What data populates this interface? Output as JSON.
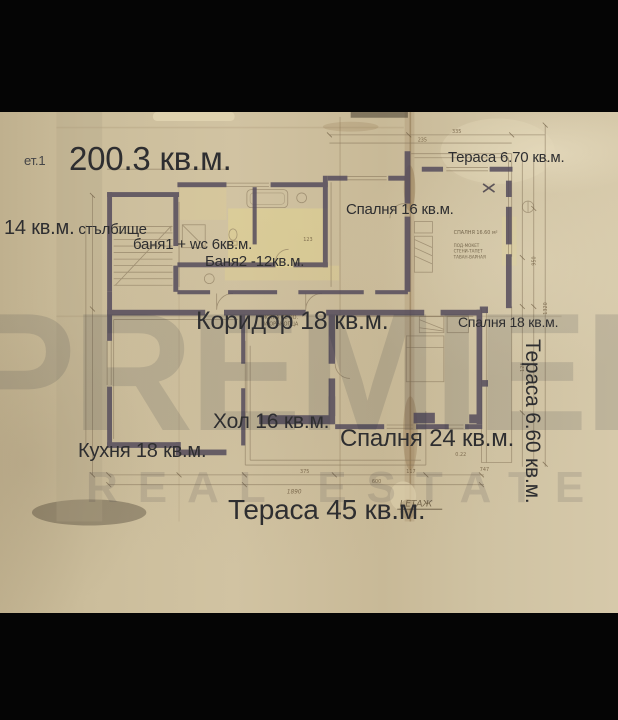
{
  "overlays": {
    "floor": "ет.1",
    "total": "200.3 кв.м.",
    "staircase_area": "14 кв.м.",
    "staircase_name": " стълбище",
    "bath1": "баня1 + wc 6кв.м.",
    "bath2": "Баня2 -12кв.м.",
    "terrace_top": "Тераса 6.70 кв.м.",
    "bedroom_16": "Спалня 16 кв.м.",
    "corridor": "Коридор 18 кв.м.",
    "bedroom_18": "Спалня 18 кв.м.",
    "terrace_right": "Тераса 6.60 кв.м.",
    "kitchen": "Кухня 18 кв.м.",
    "living": "Хол 16 кв.м.",
    "bedroom_24": "Спалня 24 кв.м.",
    "terrace_bottom": "Тераса 45 кв.м."
  },
  "watermark": {
    "line1": "PREMIER",
    "line2": "REAL ESTATE"
  },
  "plan": {
    "annotations": {
      "room_name": "СПАЛНЯ 16.60 м²",
      "finish_floor": "ПОД-МОКЕТ",
      "finish_walls": "СТЕНИ-ТАПЕТ",
      "finish_ceiling": "ТАВАН-ВАРНАЯ",
      "note1": "ЧИСТКА СЕ ПО.",
      "note2": "И ОРЪКОПЦА",
      "floor_mark": "I ЕТАЖ"
    },
    "dims": [
      "335",
      "235",
      "123",
      "950",
      "1320",
      "125",
      "375",
      "600",
      "117",
      "0.22",
      "747",
      "1890"
    ]
  },
  "colors": {
    "letterbox": "#050505",
    "paper": "#cfc2a2",
    "wall": "#554c5c",
    "pencil": "#85745a",
    "annotation_ink": "#2e2e30",
    "highlight": "#e7d88c",
    "crease": "#74572f"
  }
}
